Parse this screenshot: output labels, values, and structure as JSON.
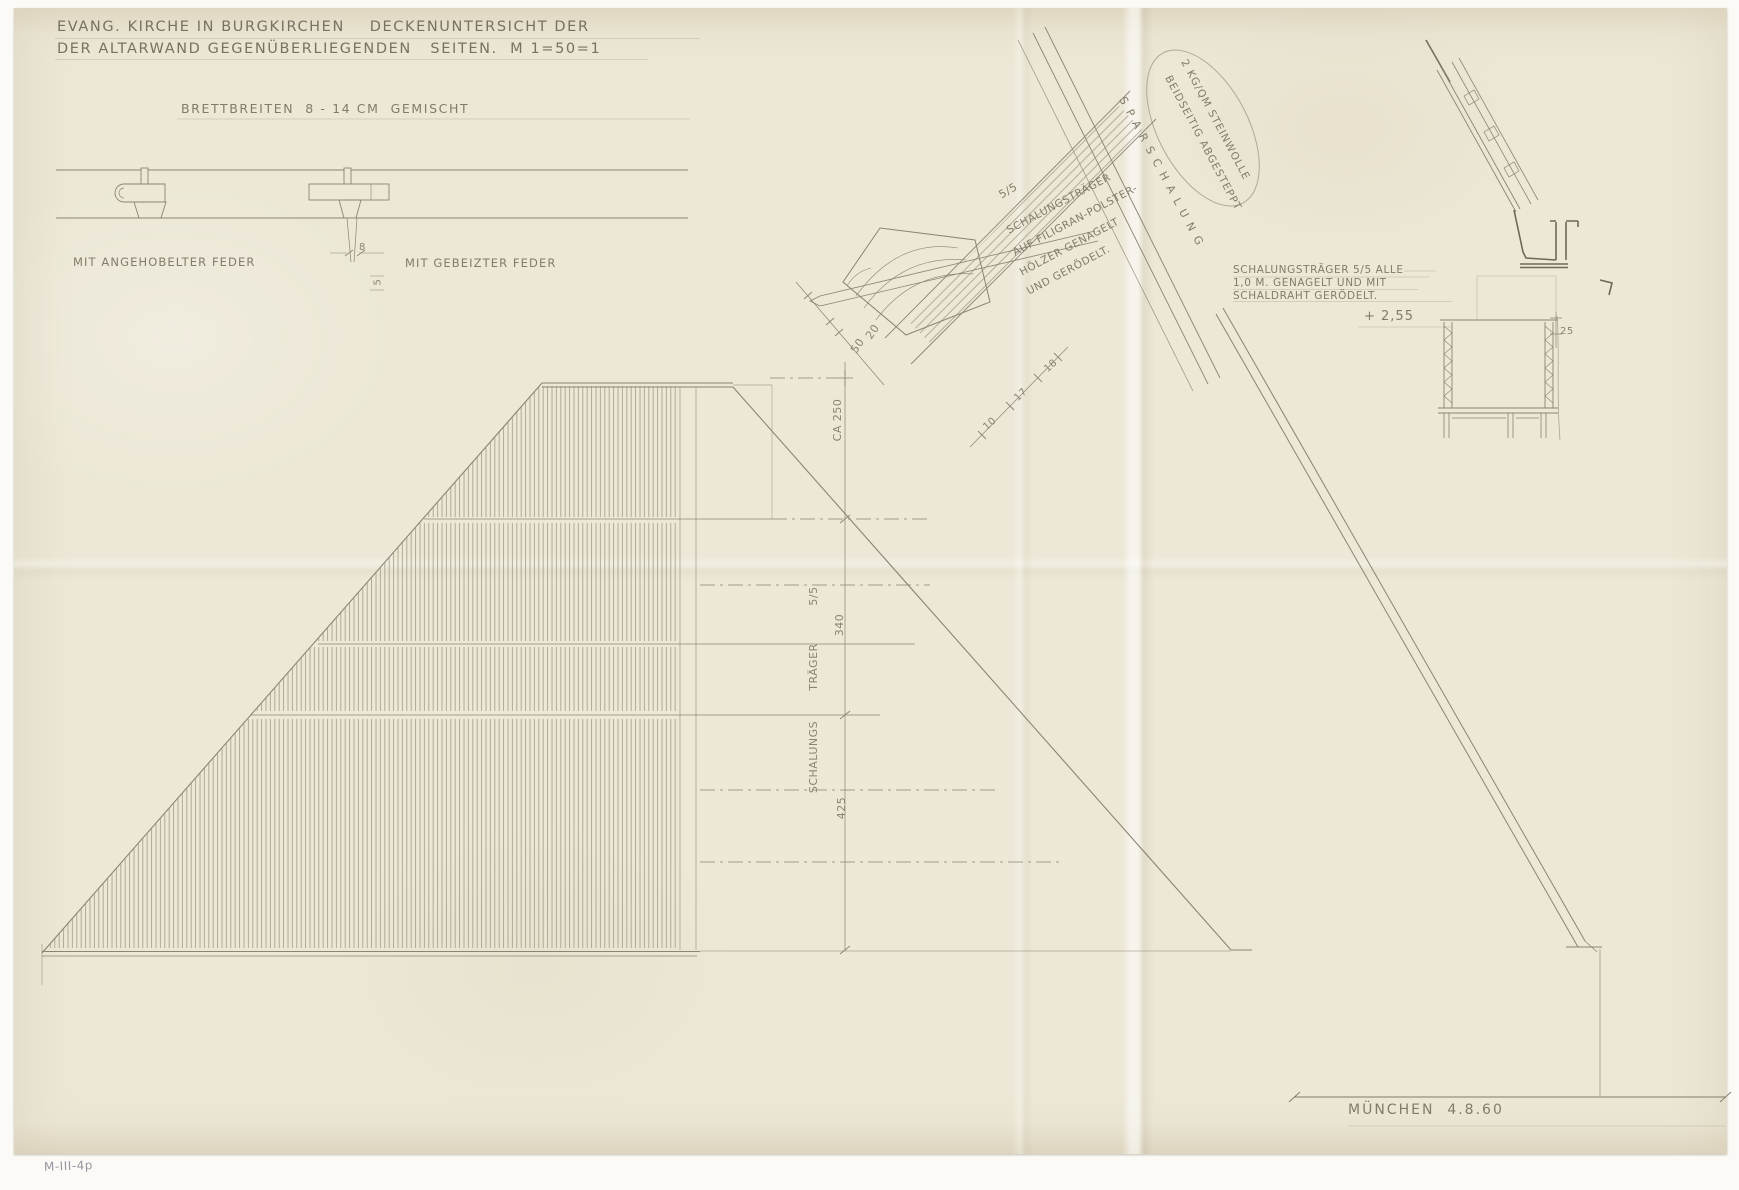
{
  "colors": {
    "paper": "#ece7d6",
    "pencil": "#8b8374",
    "pencil_dark": "#6f6859"
  },
  "title": {
    "line1": "EVANG. KIRCHE IN BURGKIRCHEN    DECKENUNTERSICHT DER",
    "line2": "DER ALTARWAND GEGENÜBERLIEGENDEN   SEITEN.  M 1=50=1"
  },
  "boards_note": "BRETTBREITEN  8 - 14 CM  GEMISCHT",
  "profiles": {
    "left_label": "MIT ANGEHOBELTER FEDER",
    "right_label": "MIT GEBEIZTER FEDER",
    "width_dim": "8",
    "depth_dim": "5"
  },
  "beam_detail": {
    "size": "5/5",
    "note_line1": "SCHALUNGSTRÄGER",
    "note_line2": "AUF FILIGRAN-POLSTER-",
    "note_line3": "HÖLZER GENAGELT",
    "note_line4": "UND GERÖDELT.",
    "sparschalung": "SPARSCHALUNG",
    "insulation_line1": "2 KG/QM STEINWOLLE",
    "insulation_line2": "BEIDSEITIG ABGESTEPPT",
    "dim_10": "10",
    "dim_17": "17",
    "dim_18": "18"
  },
  "apex_dims": {
    "dim_50": "50",
    "dim_20": "20",
    "dim_ca250": "CA 250"
  },
  "plan": {
    "col_label_1": "5/5",
    "col_label_2": "TRÄGER",
    "col_label_3": "SCHALUNGS",
    "dim_340": "340",
    "dim_425": "425"
  },
  "right_note": {
    "line1": "SCHALUNGSTRÄGER 5/5 ALLE",
    "line2": "1,0 M. GENAGELT UND MIT",
    "line3": "SCHALDRAHT GERÖDELT.",
    "level": "+ 2,55"
  },
  "eaves_section": {
    "dim_25": "25"
  },
  "footer": {
    "place_date": "MÜNCHEN  4.8.60"
  },
  "archive_mark": "M-III-4p"
}
